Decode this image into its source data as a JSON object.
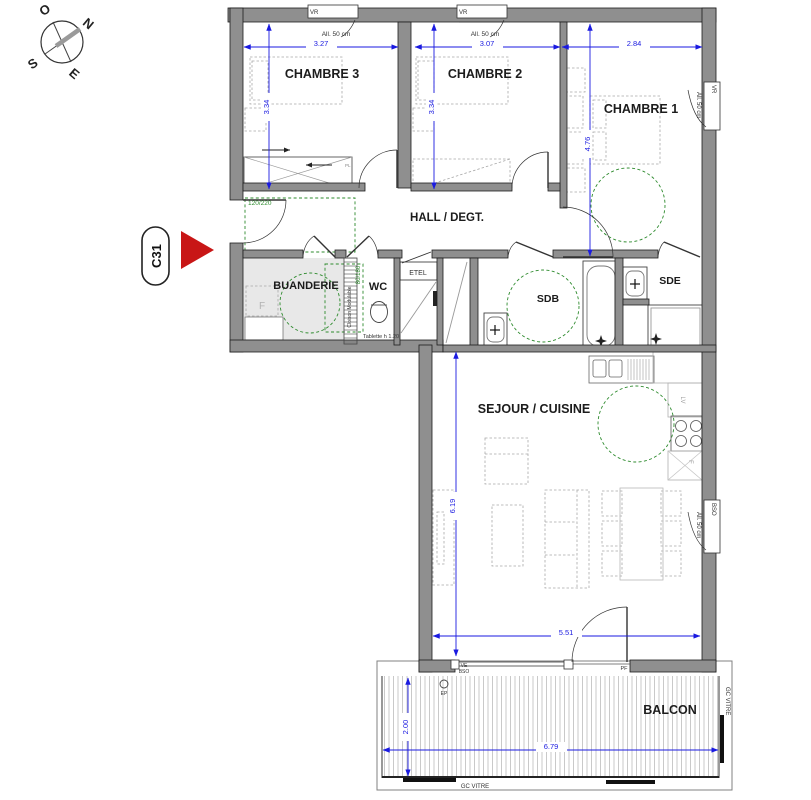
{
  "unit_label": "C31",
  "compass": {
    "n": "N",
    "s": "S",
    "e": "E",
    "o": "O"
  },
  "rooms": {
    "chambre3": "CHAMBRE 3",
    "chambre2": "CHAMBRE 2",
    "chambre1": "CHAMBRE 1",
    "hall": "HALL / DEGT.",
    "buanderie": "BUANDERIE",
    "wc": "WC",
    "sdb": "SDB",
    "sde": "SDE",
    "etel": "ETEL",
    "sejour_cuisine": "SEJOUR / CUISINE",
    "balcon": "BALCON"
  },
  "dimensions": {
    "chambre3_width": "3.27",
    "chambre2_width": "3.07",
    "chambre1_width": "2.84",
    "chambre3_depth": "3.34",
    "chambre2_depth": "3.34",
    "chambre1_depth": "4.76",
    "sejour_depth": "6.19",
    "sejour_width": "5.51",
    "balcon_width": "6.79",
    "balcon_depth": "2.00"
  },
  "annotations": {
    "vr": "VR",
    "bso": "BSO",
    "allege": "All. 50 cm",
    "reservation_door": "120/220",
    "reservation_shower": "80/180",
    "cloison": "Cloison Modulable",
    "tablette": "Tablette h 1.20",
    "placard": "PL",
    "washer": "F",
    "fridge": "F",
    "dishwasher": "LV",
    "ve": "VE",
    "ve_bso": "BSO",
    "pf": "PF",
    "ep": "EP",
    "gc_vitre": "GC VITRE"
  },
  "colors": {
    "wall_gray": "#8f8f8f",
    "dimension_blue": "#1a1ae0",
    "adaptability_green": "#2e8b2e",
    "arrow_red": "#c81616"
  }
}
